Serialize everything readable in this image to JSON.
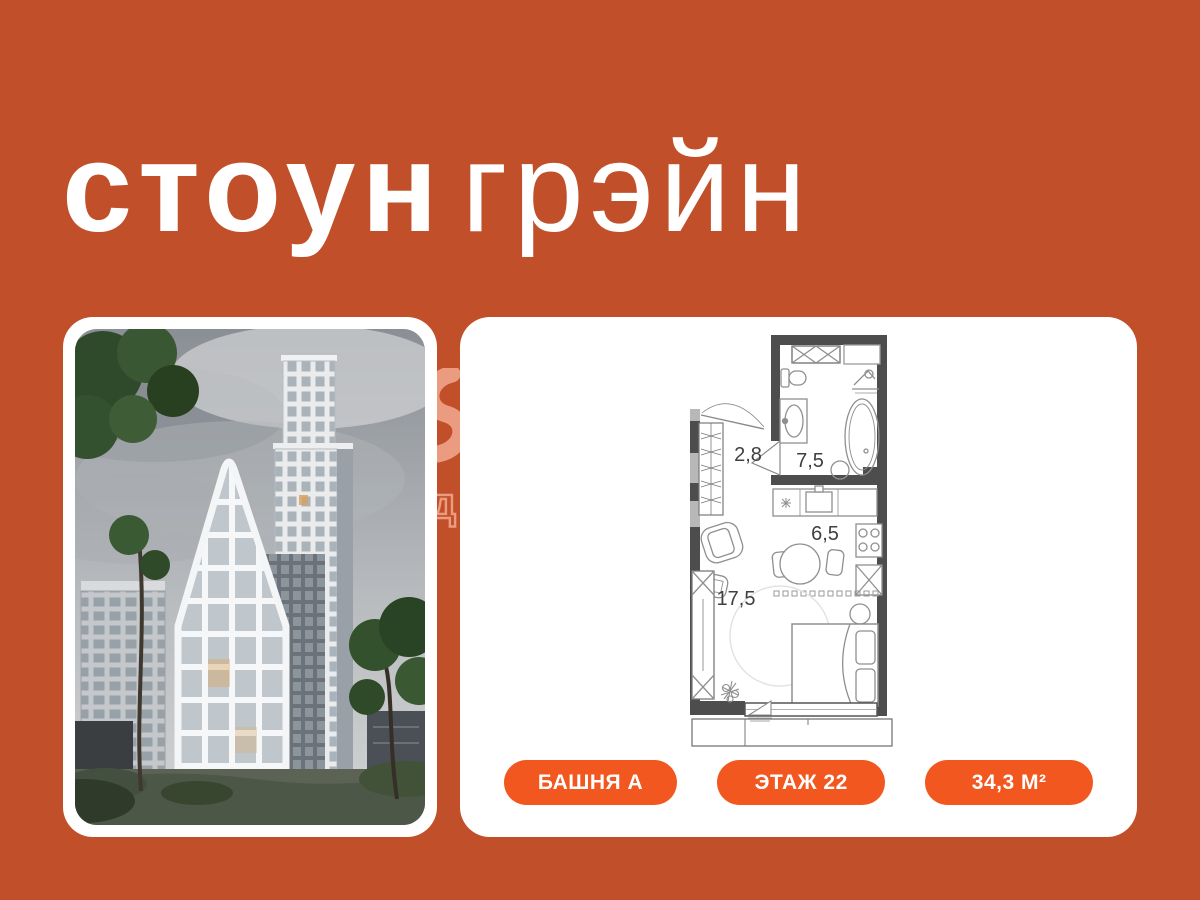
{
  "brand": {
    "logo_part1": "стоун",
    "logo_part2": "грэйн",
    "watermark_letter": "д"
  },
  "listing": {
    "tower": "БАШНЯ А",
    "floor": "ЭТАЖ 22",
    "area": "34,3 М²"
  },
  "floorplan": {
    "rooms": [
      {
        "name": "hallway",
        "area_label": "2,8"
      },
      {
        "name": "bathroom",
        "area_label": "7,5"
      },
      {
        "name": "kitchen",
        "area_label": "6,5"
      },
      {
        "name": "living-room",
        "area_label": "17,5"
      }
    ]
  },
  "colors": {
    "background": "#C1502A",
    "accent": "#F2571F",
    "card": "#FFFFFF",
    "plan_walls": "#4D4D4D",
    "watermark": "#EB9C80"
  }
}
